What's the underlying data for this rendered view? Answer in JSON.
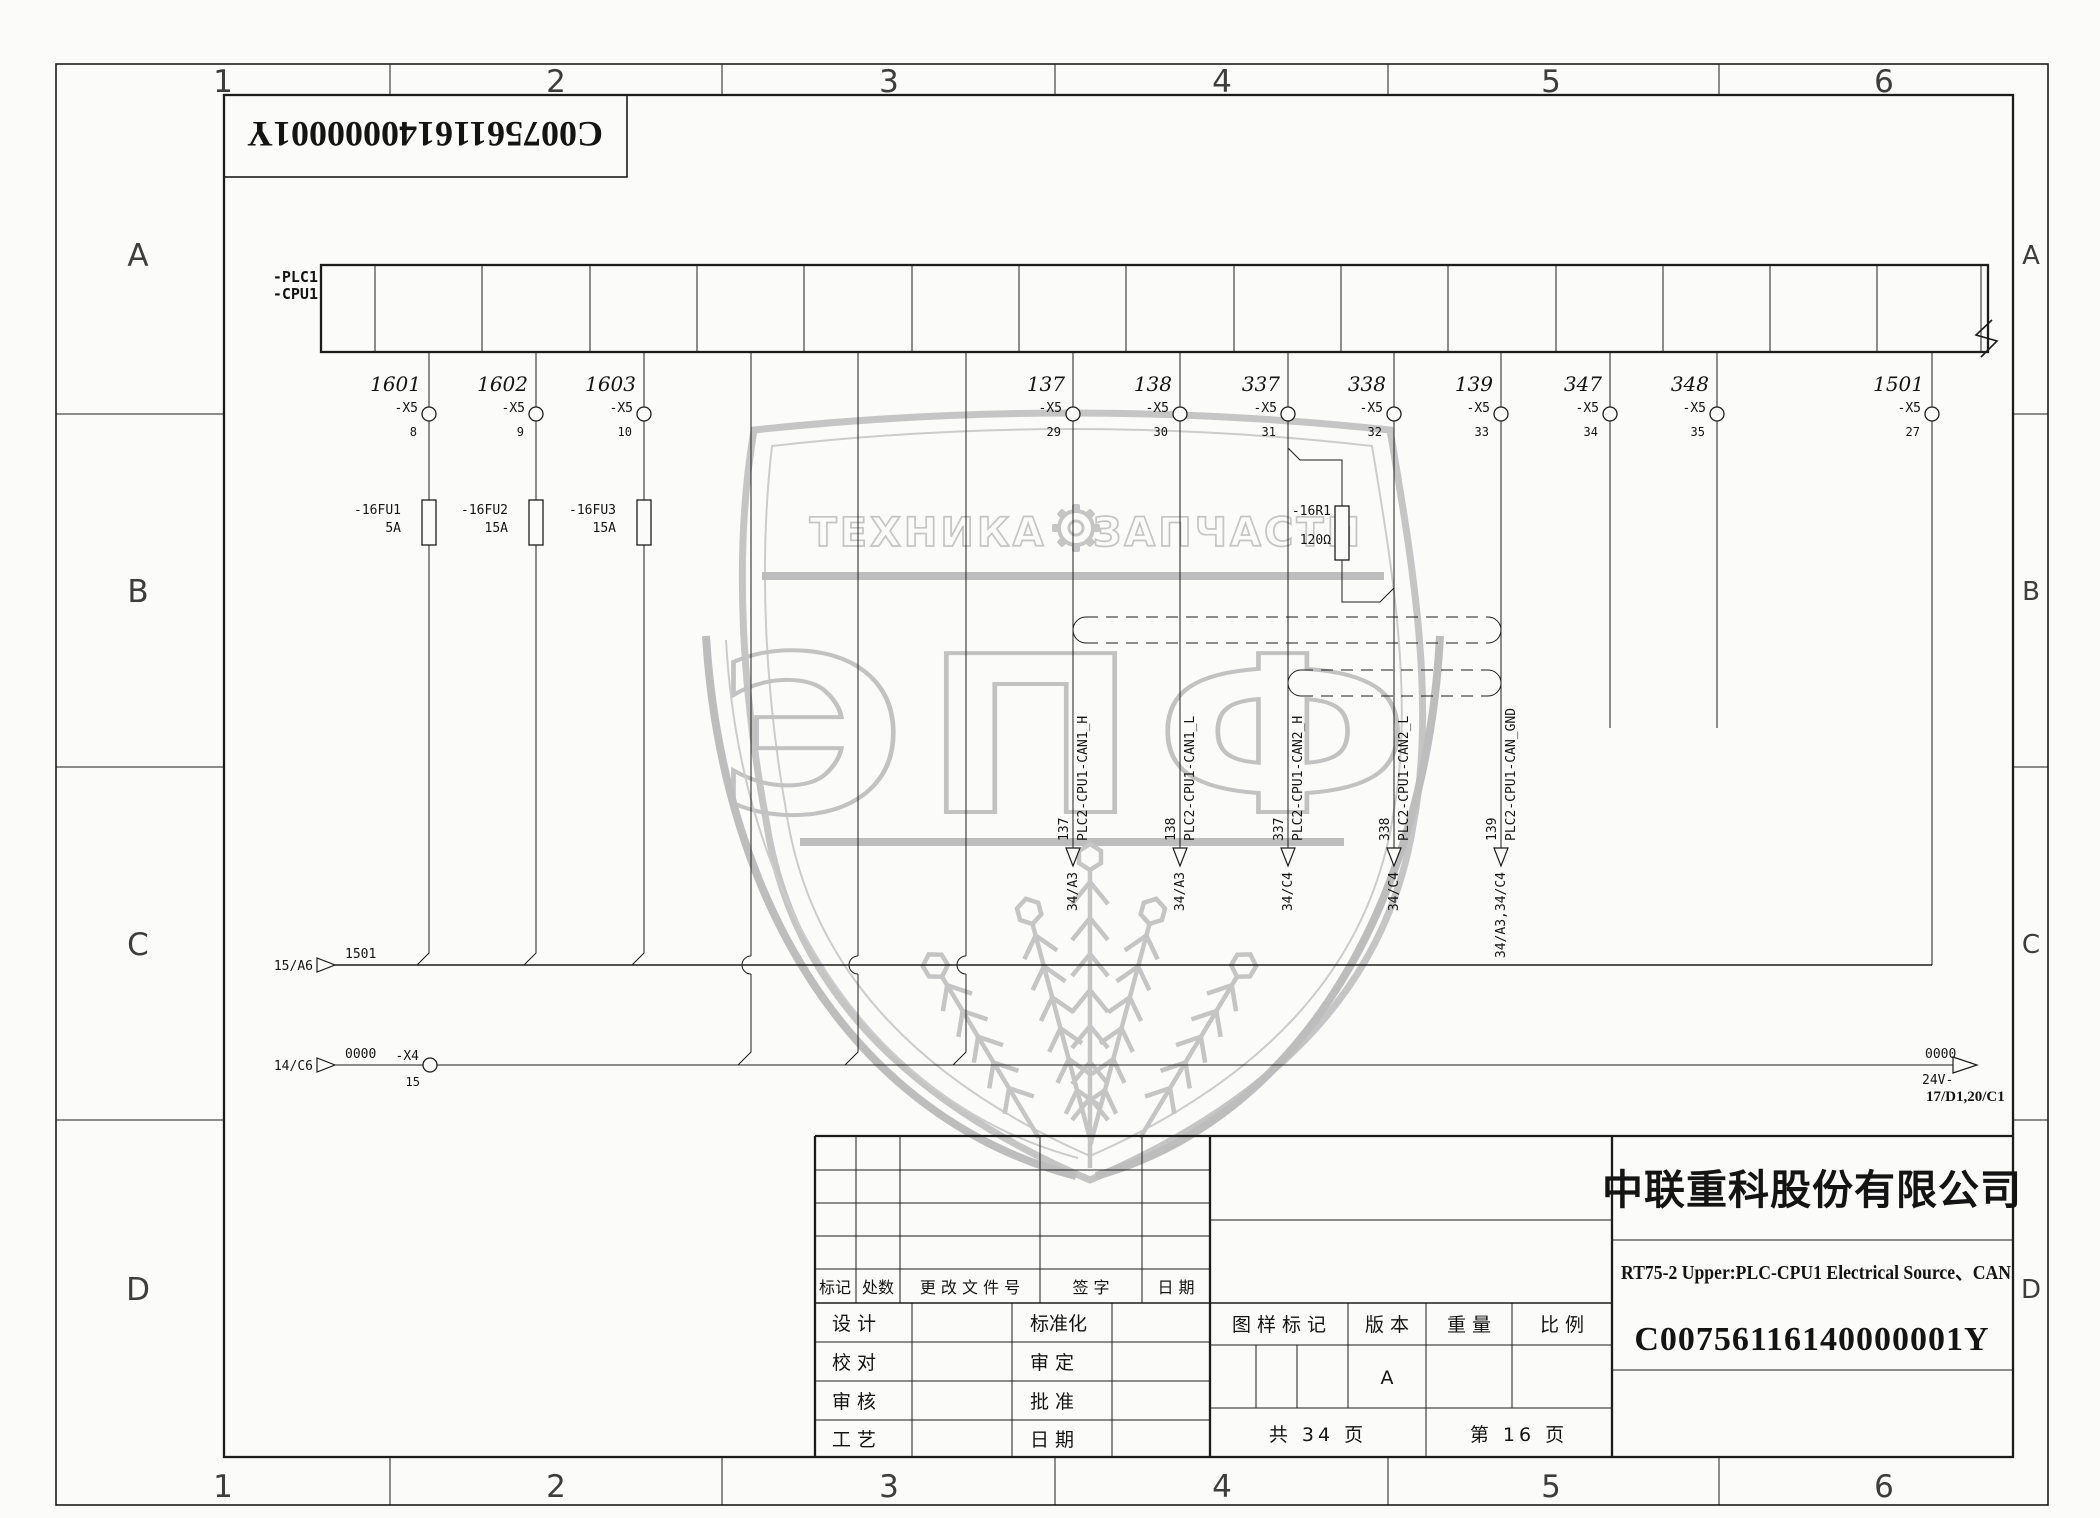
{
  "frame": {
    "columns": [
      "1",
      "2",
      "3",
      "4",
      "5",
      "6"
    ],
    "rows": [
      "A",
      "B",
      "C",
      "D"
    ]
  },
  "doc_box": {
    "number": "C00756116140000001Y"
  },
  "plc": {
    "line1": "-PLC1",
    "line2": "-CPU1"
  },
  "terminals": {
    "conn": "-X5",
    "wires": [
      "1601",
      "1602",
      "1603",
      "137",
      "138",
      "337",
      "338",
      "139",
      "347",
      "348",
      "1501"
    ],
    "pins": [
      "8",
      "9",
      "10",
      "29",
      "30",
      "31",
      "32",
      "33",
      "34",
      "35",
      "27"
    ]
  },
  "fuses": {
    "names": [
      "-16FU1",
      "-16FU2",
      "-16FU3"
    ],
    "ratings": [
      "5A",
      "15A",
      "15A"
    ]
  },
  "resistor": {
    "name": "-16R1",
    "value": "120Ω"
  },
  "can": {
    "wires": [
      "137",
      "138",
      "337",
      "338",
      "139"
    ],
    "names": [
      "PLC2-CPU1-CAN1_H",
      "PLC2-CPU1-CAN1_L",
      "PLC2-CPU1-CAN2_H",
      "PLC2-CPU1-CAN2_L",
      "PLC2-CPU1-CAN_GND"
    ],
    "refs": [
      "34/A3",
      "34/A3",
      "34/C4",
      "34/C4",
      "34/A3,34/C4"
    ]
  },
  "bus1501": {
    "source": "15/A6",
    "wire": "1501"
  },
  "bus0000": {
    "source": "14/C6",
    "wire": "0000",
    "terminal": "-X4",
    "pin": "15",
    "end_wire": "0000",
    "end_polarity": "24V-",
    "end_ref": "17/D1,20/C1"
  },
  "watermark": {
    "word1": "ТЕХНИКА",
    "word2": "ЗАПЧАСТИ",
    "big": "ЭПФ"
  },
  "title_block": {
    "rev_headers": [
      "标记",
      "处数",
      "更 改 文 件 号",
      "签  字",
      "日  期"
    ],
    "sig_left": [
      "设  计",
      "校  对",
      "审  核",
      "工  艺"
    ],
    "sig_right": [
      "标准化",
      "审  定",
      "批  准",
      "日  期"
    ],
    "stamp": {
      "mark": "图 样 标 记",
      "version_label": "版 本",
      "version": "A",
      "weight_label": "重 量",
      "scale_label": "比 例"
    },
    "pages": {
      "total": "共  34  页",
      "current": "第  16  页"
    },
    "company": "中联重科股份有限公司",
    "title": "RT75-2 Upper:PLC-CPU1 Electrical Source、CAN",
    "drawing_no": "C00756116140000001Y"
  }
}
